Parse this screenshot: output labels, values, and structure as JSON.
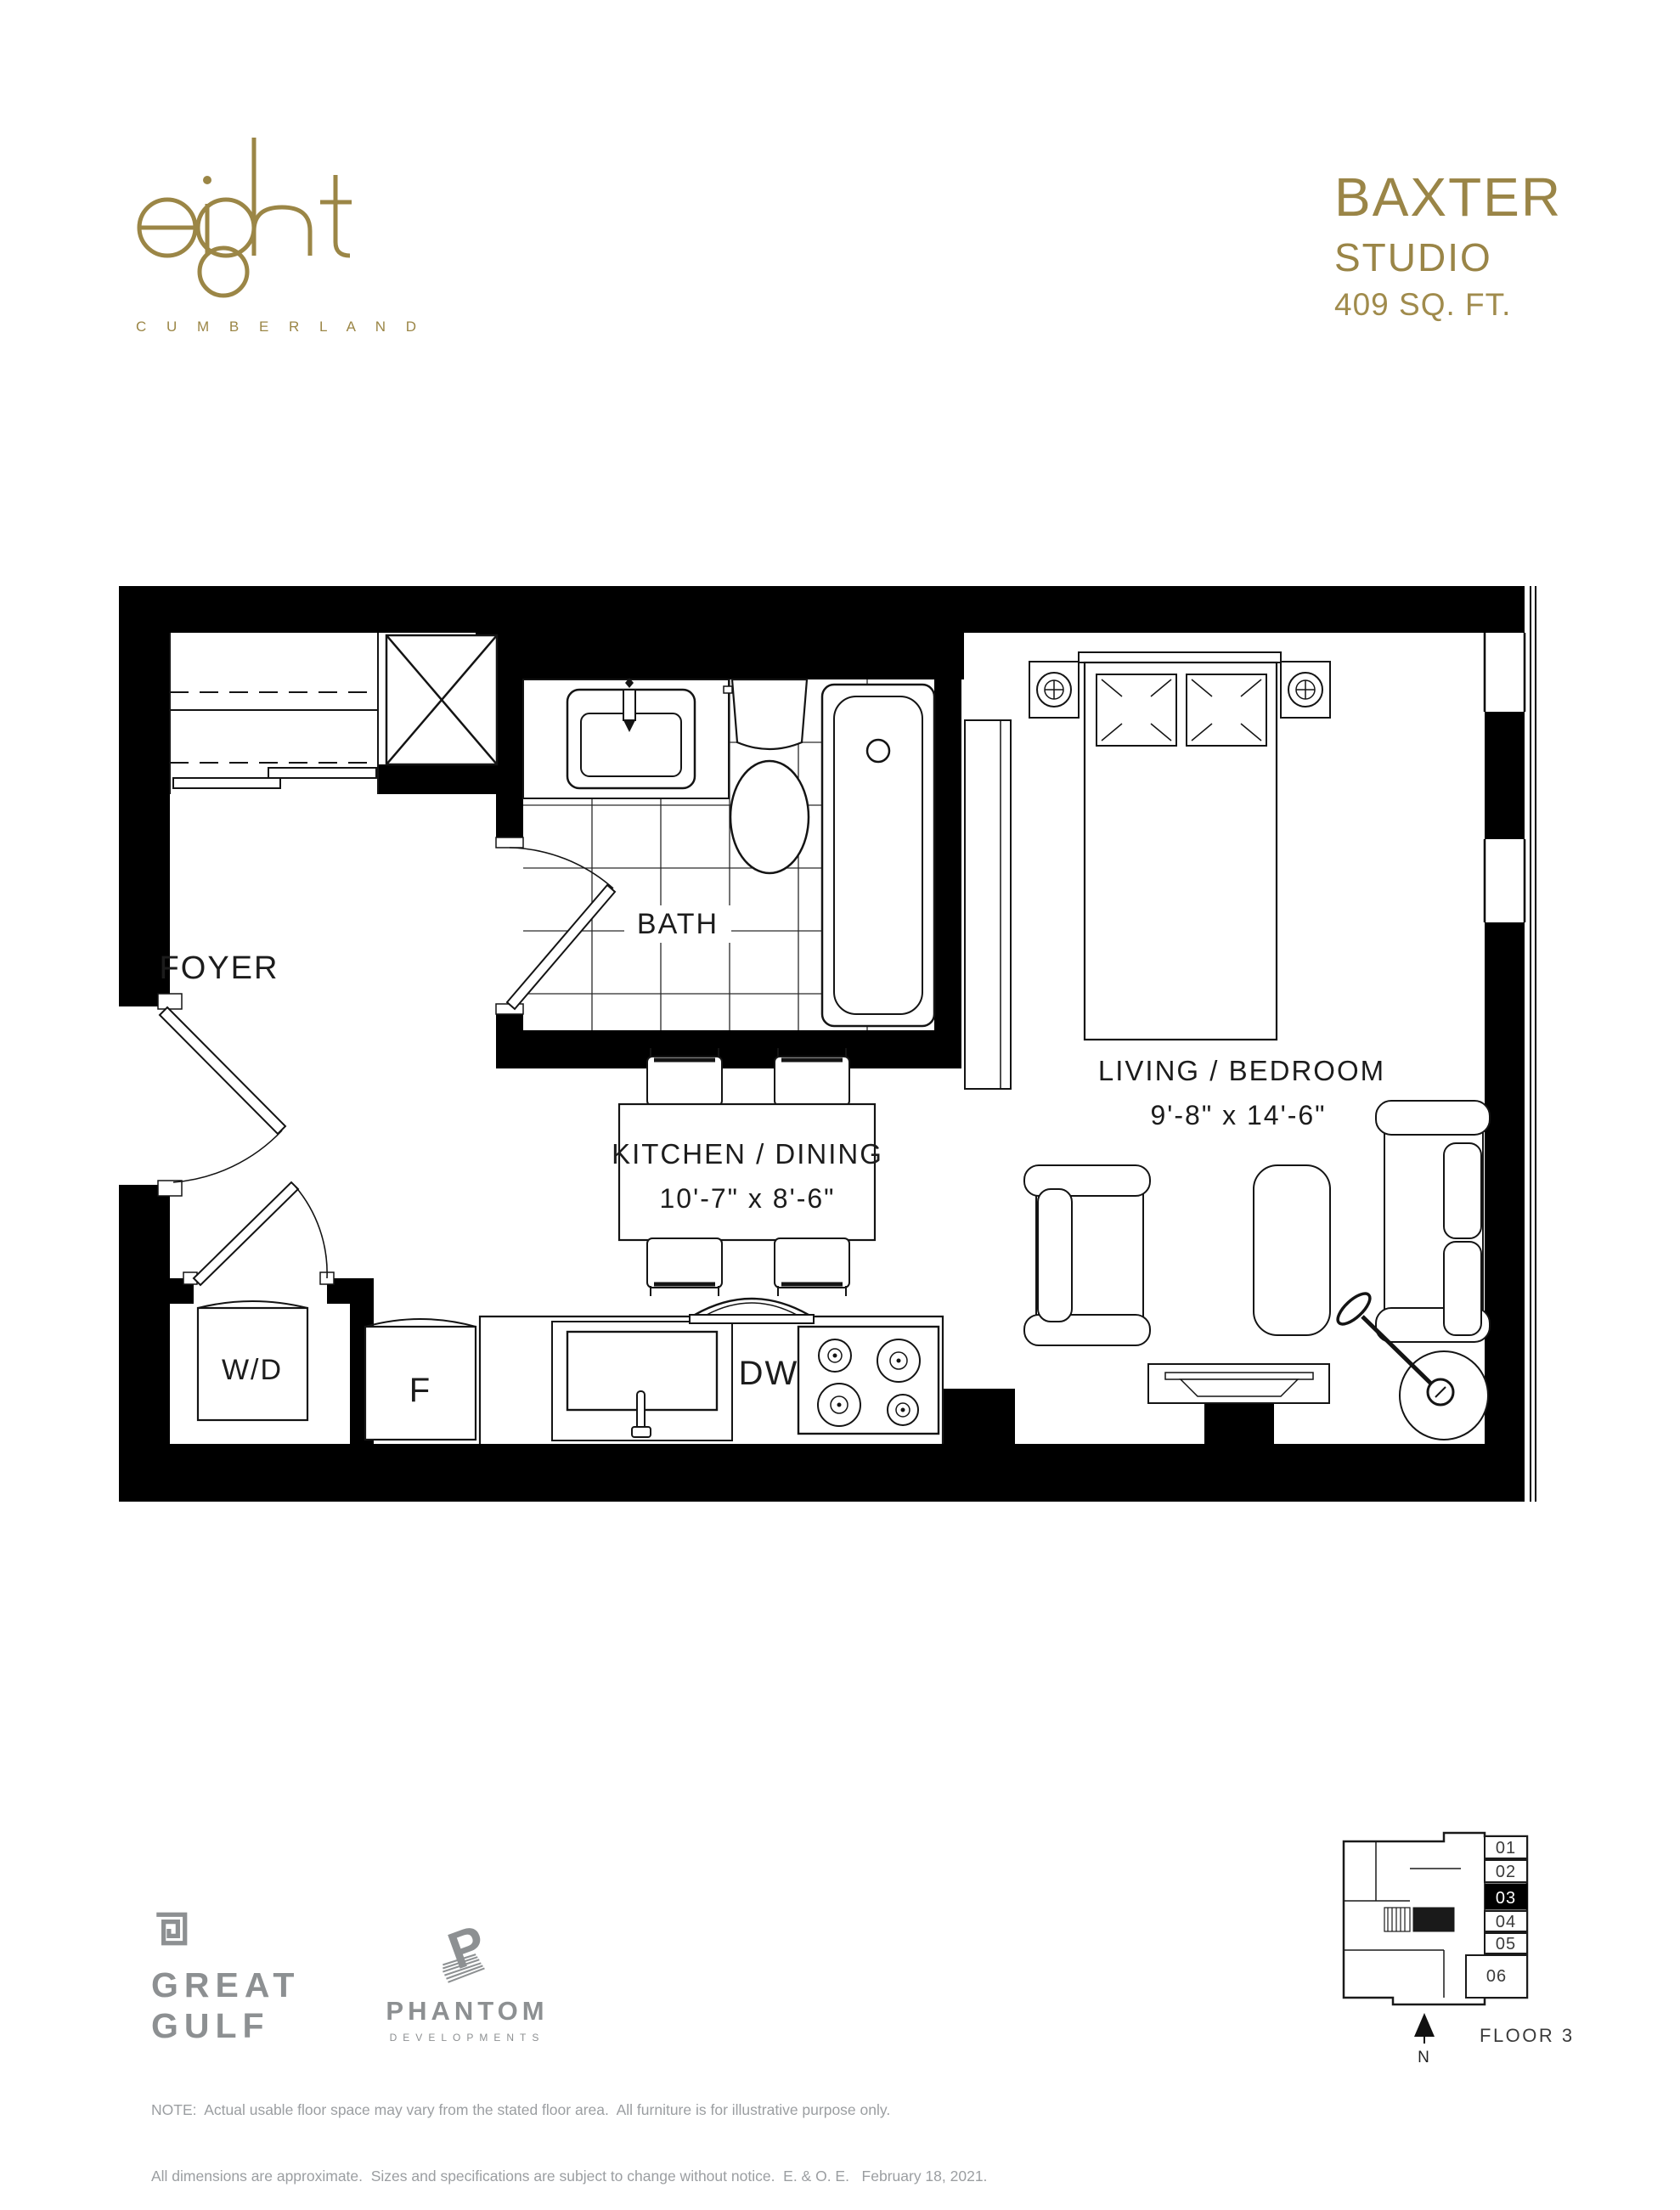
{
  "colors": {
    "gold": "#9A8547",
    "logo_gold": "#9B8646",
    "logo_gray": "#8D9092",
    "note_gray": "#9B9EA1",
    "line_black": "#000000"
  },
  "header": {
    "brand": {
      "name": "eight",
      "location": "C U M B E R L A N D"
    },
    "unit": {
      "name": "BAXTER",
      "type": "STUDIO",
      "area": "409 SQ. FT."
    }
  },
  "plan": {
    "rooms": {
      "foyer": "FOYER",
      "bath": "BATH",
      "kitchen_dining": {
        "label": "KITCHEN / DINING",
        "dims": "10'-7\" x 8'-6\""
      },
      "living_bedroom": {
        "label": "LIVING / BEDROOM",
        "dims": "9'-8\" x 14'-6\""
      }
    },
    "appliances": {
      "washer_dryer": "W/D",
      "fridge": "F",
      "dishwasher": "DW"
    }
  },
  "keyplan": {
    "units": [
      "01",
      "02",
      "03",
      "04",
      "05",
      "06"
    ],
    "highlighted_unit": "03",
    "floor": "FLOOR 3",
    "north": "N"
  },
  "footer": {
    "great_gulf": {
      "line1": "GREAT",
      "line2": "GULF"
    },
    "phantom": {
      "name": "PHANTOM",
      "sub": "DEVELOPMENTS"
    },
    "note_line1": "NOTE:  Actual usable floor space may vary from the stated floor area.  All furniture is for illustrative purpose only.",
    "note_line2": "All dimensions are approximate.  Sizes and specifications are subject to change without notice.  E. & O. E.   February 18, 2021."
  }
}
